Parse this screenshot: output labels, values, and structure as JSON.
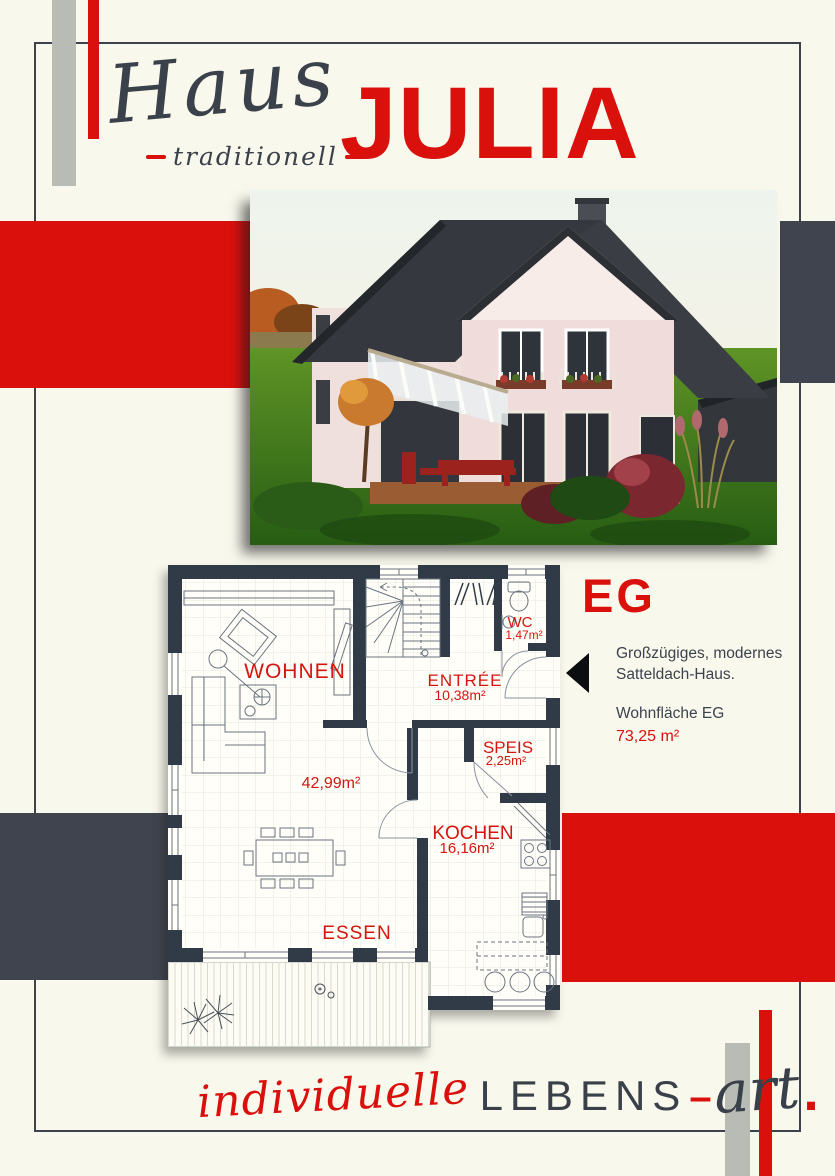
{
  "header": {
    "script_word": "Haus",
    "tagline": "traditionell",
    "model_name": "JULIA"
  },
  "info": {
    "floor_label": "EG",
    "description_line1": "Großzügiges, modernes",
    "description_line2": "Satteldach-Haus.",
    "area_label": "Wohnfläche EG",
    "area_value": "73,25 m²"
  },
  "floor_plan": {
    "rooms": {
      "wohnen": {
        "label": "WOHNEN"
      },
      "living_area_value": "42,99m²",
      "entree": {
        "label": "ENTRÉE",
        "area": "10,38m²"
      },
      "wc": {
        "label": "WC",
        "area": "1,47m²"
      },
      "speis": {
        "label": "SPEIS",
        "area": "2,25m²"
      },
      "kochen": {
        "label": "KOCHEN",
        "area": "16,16m²"
      },
      "essen": {
        "label": "ESSEN"
      }
    }
  },
  "footer": {
    "word_script_red": "individuelle",
    "word_caps": "LEBENS",
    "hyphen": "–",
    "word_script_dark": "art",
    "period": "."
  },
  "colors": {
    "accent_red": "#da100c",
    "wall_dark": "#313b48",
    "block_dark": "#40444e",
    "silver": "#b9bcb5",
    "background": "#f9f8ec"
  }
}
